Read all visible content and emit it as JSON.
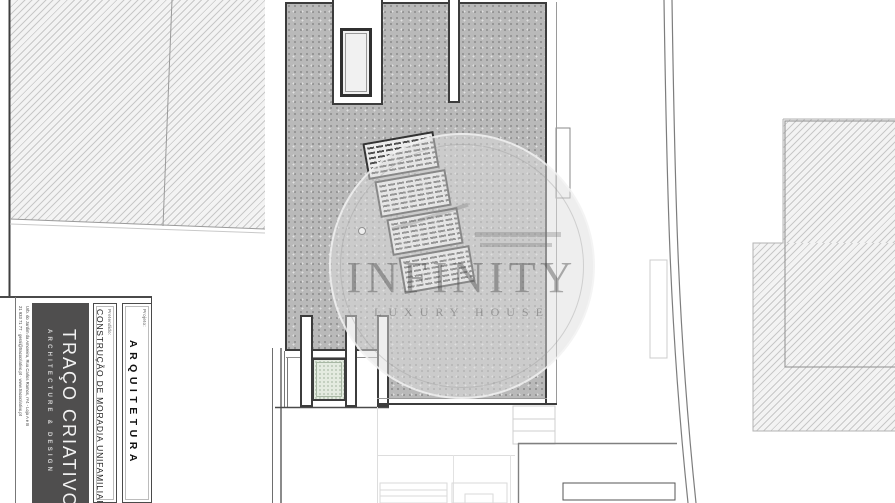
{
  "document": {
    "kind": "architectural roof / site plan drawing",
    "sheet_background": "#ffffff"
  },
  "watermark": {
    "title": "INFINITY",
    "subtitle": "LUXURY HOUSE"
  },
  "title_block": {
    "contact_address": "Urb. do Jardim da Amoreira, Rua Carlos Ramos, nº4 - Loja A e B",
    "contact_details": "21 933 71 77  ·  geral@tracocriativo.pt  ·  www.tracocriativo.pt",
    "company_name": "TRAÇO CRIATIVO",
    "company_tagline": "ARCHITECTURE & DESIGN",
    "request_label": "Pretendido:",
    "request_value": "CONSTRUÇÃO DE MORADIA UNIFAMILIAR",
    "project_label": "Projeto:",
    "project_value": "ARQUITETURA"
  },
  "drawing": {
    "colors": {
      "roof_fill": "#b9b9b9",
      "outline": "#3c3c3c",
      "neighbor_hatch_bg": "#f3f3f3",
      "patio_skylight_fill": "#e4ebe0"
    },
    "solar_panel_array": {
      "panel_count": 4,
      "tilt_degrees": -10
    },
    "features": [
      "main-roof",
      "roof-skylight",
      "roof-vent",
      "solar-panel-array",
      "patio-skylight",
      "chimney-wall",
      "neighbor-plot-left",
      "neighbor-building-right",
      "site-boundary-road",
      "exterior-stairs",
      "lower-terrace",
      "terrace-equipment"
    ]
  }
}
